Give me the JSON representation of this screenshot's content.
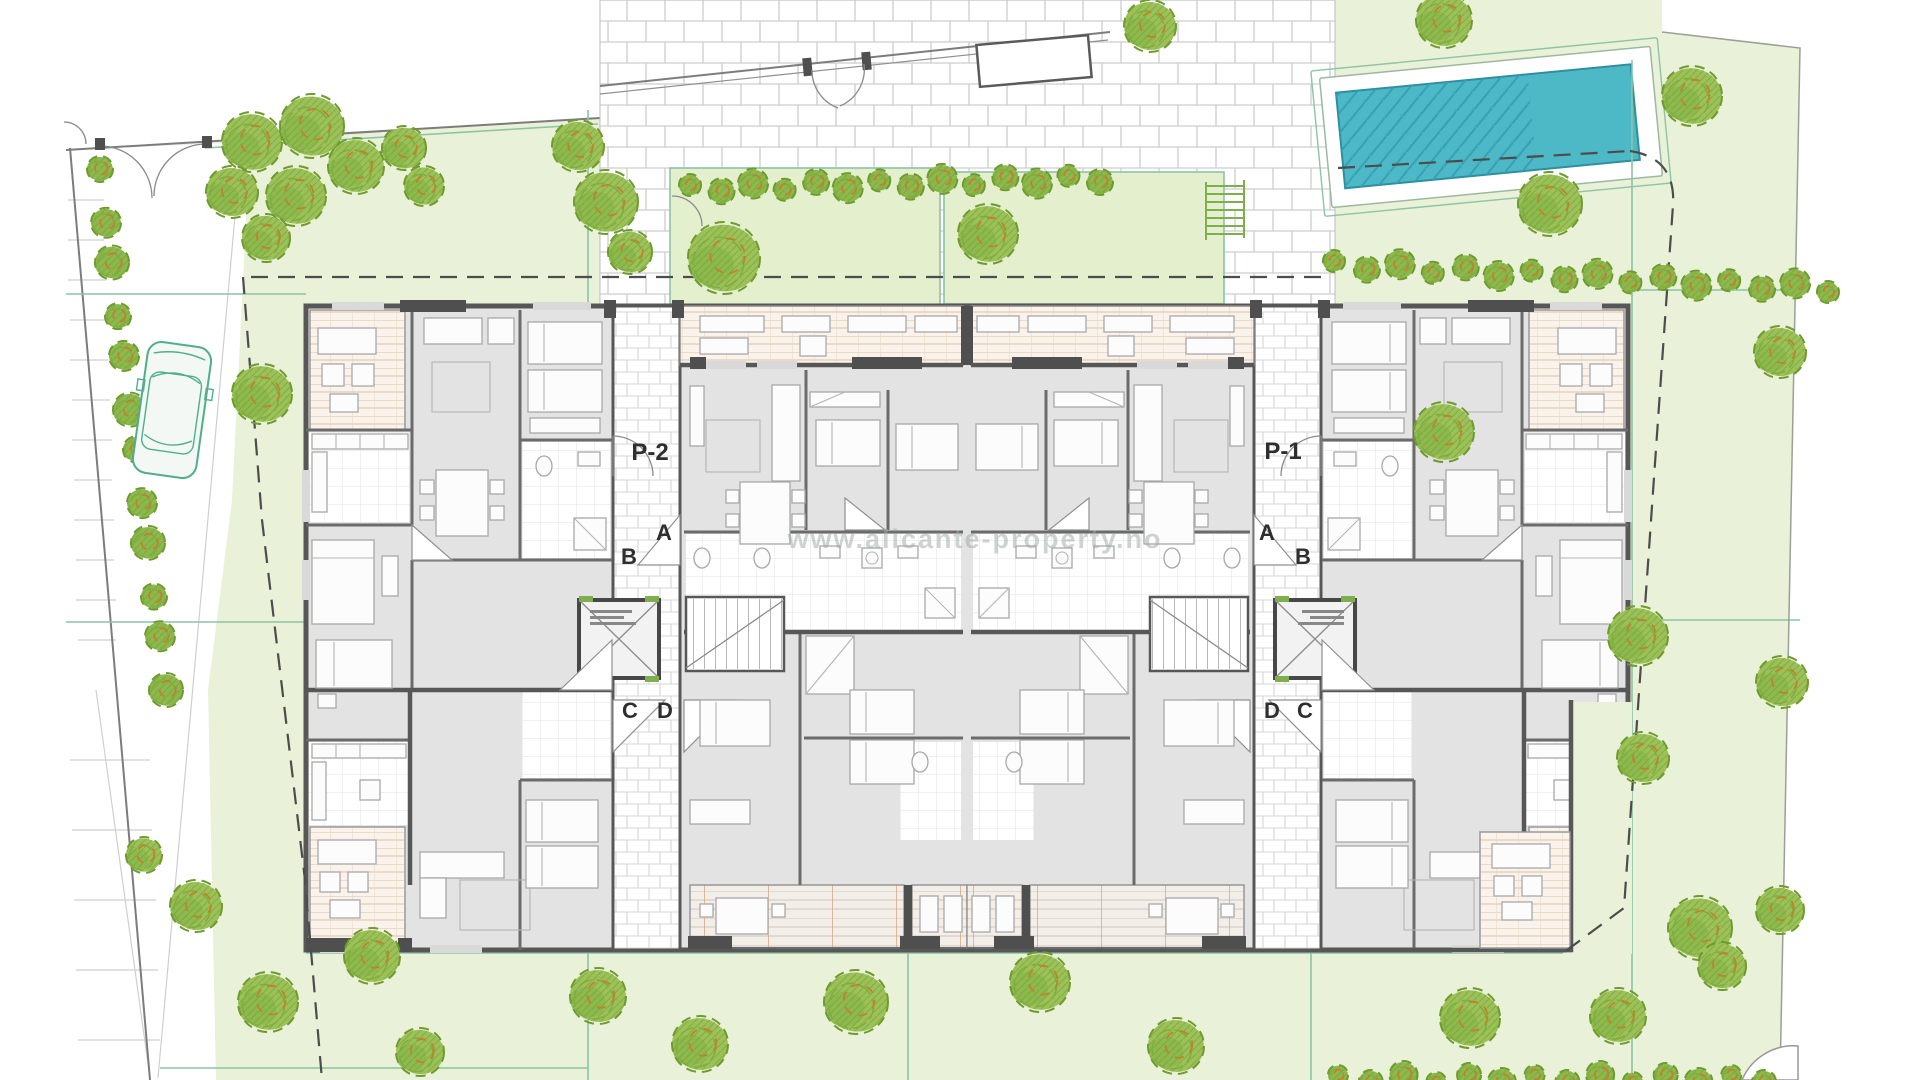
{
  "drawing": {
    "type": "architectural-site-plan",
    "labels": {
      "portal_left": "P-2",
      "portal_right": "P-1",
      "door_a": "A",
      "door_b": "B",
      "door_c": "C",
      "door_d": "D"
    },
    "watermark": "www.alicante-property.no",
    "colors": {
      "site-green": "#e9f1d8",
      "courtyard-green": "#e4efcd",
      "plaza-line": "#cdcdcd",
      "pool-water": "#4db9c6",
      "pool-hatch": "#35a0b2",
      "pool-border": "#2d8fa0",
      "tree-fill": "#9cc158",
      "tree-dark": "#6f9a2e",
      "tree-mid": "#7fae3f",
      "tree-accent": "#c2812f",
      "hedge-fill": "#8cb84d",
      "wall": "#575757",
      "wall-dark": "#4f4f4f",
      "room-grey": "#e3e3e3",
      "terrace-line": "#ddc1a4",
      "deck-line": "#cdc6bc",
      "deck-accent": "#d9a272",
      "plot-line": "#8cc4a4",
      "boundary-dash": "#4c4c4c",
      "car-line": "#4fae8f",
      "watermark-grey": "#9baaa4"
    },
    "trees": {
      "large": [
        [
          252,
          142,
          30
        ],
        [
          312,
          126,
          32
        ],
        [
          232,
          192,
          26
        ],
        [
          296,
          196,
          30
        ],
        [
          356,
          166,
          28
        ],
        [
          404,
          148,
          22
        ],
        [
          266,
          238,
          24
        ],
        [
          424,
          186,
          20
        ],
        [
          578,
          146,
          26
        ],
        [
          606,
          202,
          32
        ],
        [
          630,
          252,
          22
        ],
        [
          262,
          394,
          30
        ],
        [
          196,
          906,
          26
        ],
        [
          144,
          855,
          18
        ],
        [
          372,
          956,
          28
        ],
        [
          268,
          1002,
          30
        ],
        [
          420,
          1052,
          24
        ],
        [
          598,
          996,
          28
        ],
        [
          700,
          1044,
          28
        ],
        [
          856,
          1002,
          32
        ],
        [
          1040,
          982,
          30
        ],
        [
          1176,
          1046,
          28
        ],
        [
          724,
          258,
          36
        ],
        [
          988,
          234,
          30
        ],
        [
          1150,
          26,
          26
        ],
        [
          1444,
          20,
          28
        ],
        [
          1692,
          96,
          30
        ],
        [
          1550,
          204,
          32
        ],
        [
          1780,
          352,
          26
        ],
        [
          1444,
          432,
          30
        ],
        [
          1638,
          636,
          30
        ],
        [
          1782,
          682,
          26
        ],
        [
          1643,
          758,
          26
        ],
        [
          1700,
          928,
          32
        ],
        [
          1722,
          966,
          24
        ],
        [
          1470,
          1018,
          30
        ],
        [
          1618,
          1016,
          28
        ],
        [
          1780,
          910,
          24
        ]
      ],
      "hedgerows": [
        {
          "from": [
            690,
            188
          ],
          "to": [
            1100,
            178
          ],
          "count": 14,
          "radius": 13
        },
        {
          "from": [
            1334,
            264
          ],
          "to": [
            1828,
            288
          ],
          "count": 16,
          "radius": 13
        },
        {
          "from": [
            1338,
            1078
          ],
          "to": [
            1764,
            1078
          ],
          "count": 14,
          "radius": 12
        },
        {
          "from": [
            100,
            172
          ],
          "to": [
            166,
            686
          ],
          "count": 12,
          "radius": 15
        }
      ]
    },
    "pool": {
      "x": 1325,
      "y": 62,
      "width": 332,
      "height": 130,
      "angle": -5.5
    },
    "car": {
      "x": 172,
      "y": 410,
      "angle": 8
    }
  }
}
